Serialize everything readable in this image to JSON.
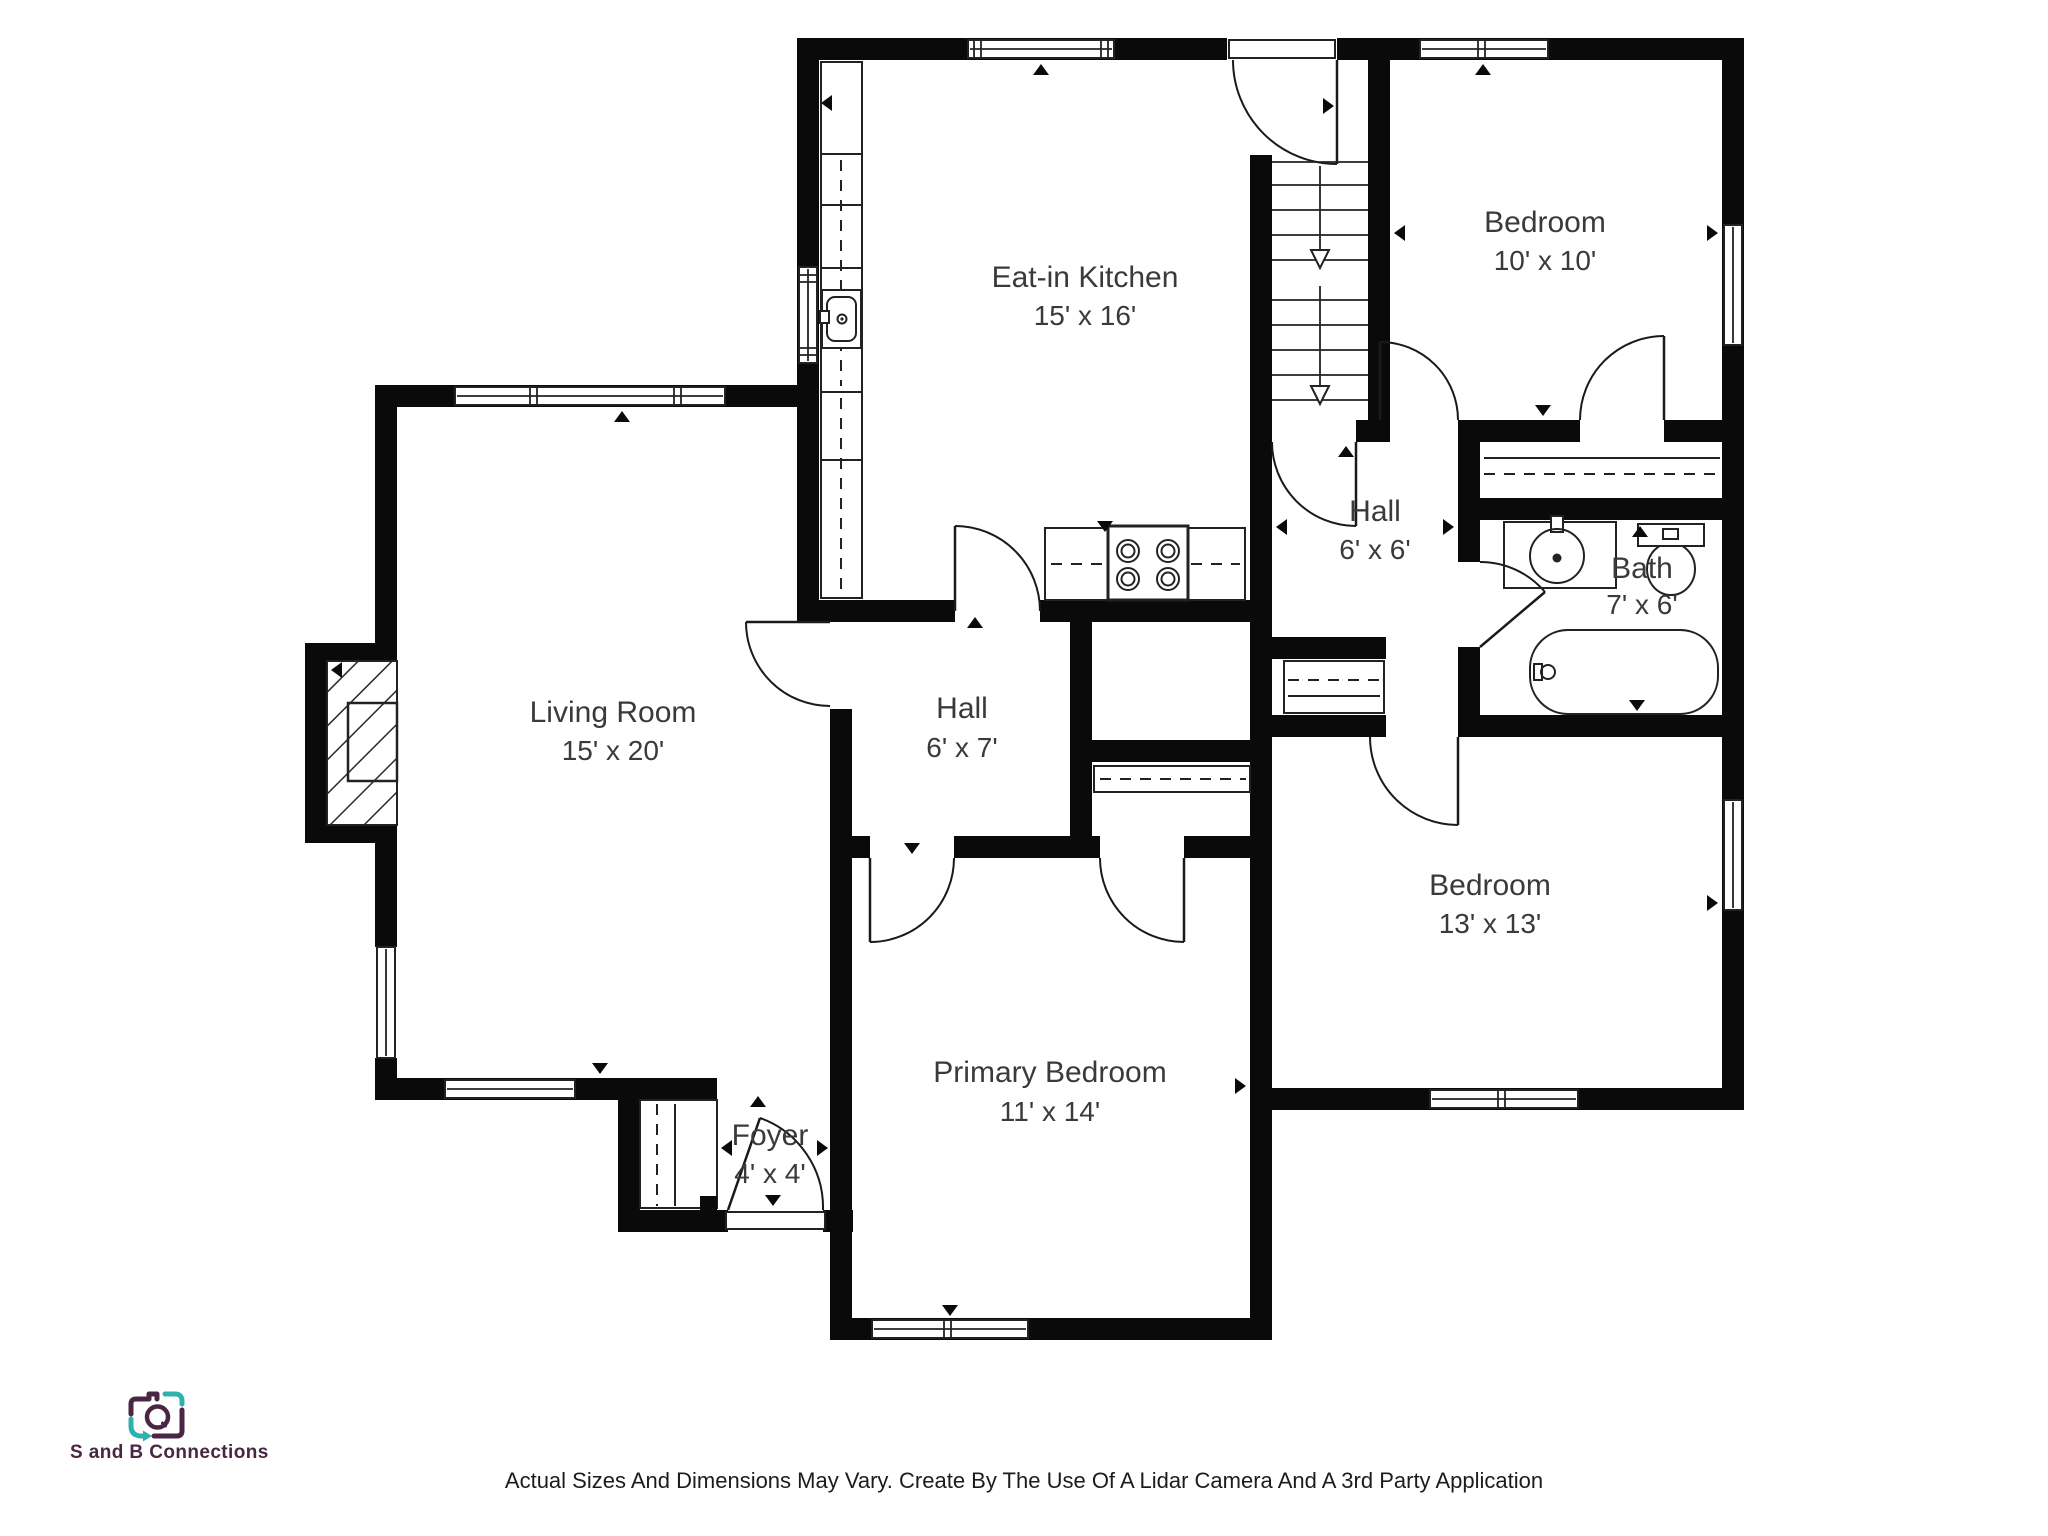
{
  "rooms": [
    {
      "id": "eat-in-kitchen",
      "name": "Eat-in Kitchen",
      "dims": "15' x 16'"
    },
    {
      "id": "bedroom-10",
      "name": "Bedroom",
      "dims": "10' x 10'"
    },
    {
      "id": "hall-6x6",
      "name": "Hall",
      "dims": "6' x 6'"
    },
    {
      "id": "bath",
      "name": "Bath",
      "dims": "7' x 6'"
    },
    {
      "id": "living-room",
      "name": "Living Room",
      "dims": "15' x 20'"
    },
    {
      "id": "hall-6x7",
      "name": "Hall",
      "dims": "6' x 7'"
    },
    {
      "id": "bedroom-13",
      "name": "Bedroom",
      "dims": "13' x 13'"
    },
    {
      "id": "primary-bedroom",
      "name": "Primary Bedroom",
      "dims": "11' x 14'"
    },
    {
      "id": "foyer",
      "name": "Foyer",
      "dims": "4' x 4'"
    }
  ],
  "fixtures": {
    "staircase": "stairs with down arrows",
    "fireplace": "hatched fireplace",
    "kitchen_sink": "sink",
    "stove": "4-burner stove",
    "bath_sink": "vanity sink",
    "toilet": "toilet",
    "bathtub": "bathtub",
    "closets": "dashed rod closets"
  },
  "logo": {
    "text": "S and B Connections",
    "icon": "camera-icon",
    "colors": {
      "purple": "#4a2645",
      "teal": "#2fb2ad"
    }
  },
  "footer": {
    "disclaimer": "Actual Sizes And Dimensions May Vary. Create By The Use Of A Lidar Camera And A 3rd Party Application"
  },
  "colors": {
    "wall": "#0a0a0a",
    "line": "#222222",
    "label": "#3a3a3a",
    "background": "#ffffff"
  }
}
